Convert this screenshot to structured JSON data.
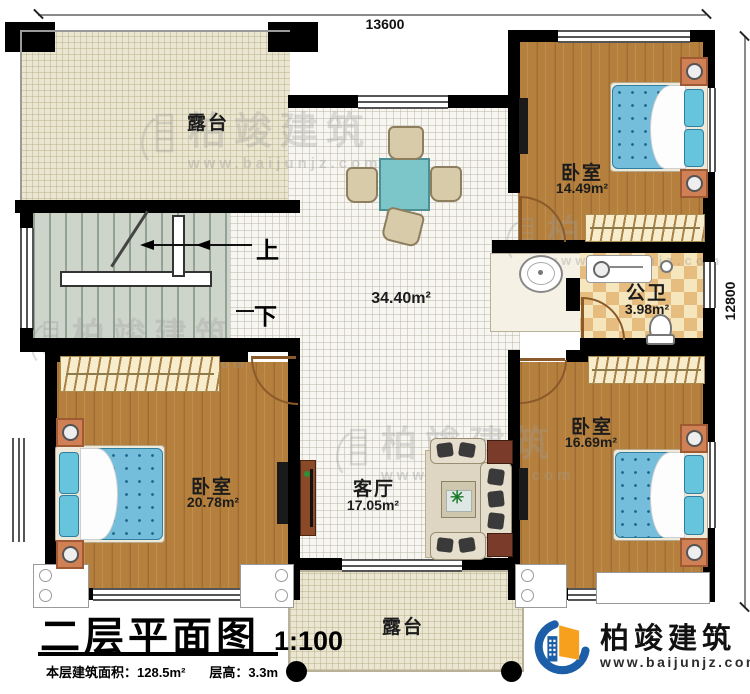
{
  "meta": {
    "title": "二层平面图",
    "scale": "1:100",
    "area_stat": "本层建筑面积：128.5m²",
    "floor_height_stat": "层高：3.3m"
  },
  "dims": {
    "top": "13600",
    "right": "12800"
  },
  "rooms": {
    "terrace_top": {
      "name": "露台"
    },
    "bedroom_top_right": {
      "name": "卧室",
      "area": "14.49m²"
    },
    "bathroom": {
      "name": "公卫",
      "area": "3.98m²"
    },
    "hall": {
      "area": "34.40m²"
    },
    "living": {
      "name": "客厅",
      "area": "17.05m²"
    },
    "bedroom_bottom_left": {
      "name": "卧室",
      "area": "20.78m²"
    },
    "bedroom_bottom_right": {
      "name": "卧室",
      "area": "16.69m²"
    },
    "terrace_bottom": {
      "name": "露台"
    }
  },
  "stairs": {
    "up": "上",
    "down": "下"
  },
  "brand": {
    "name": "柏竣建筑",
    "url": "www.baijunjz.com"
  },
  "watermark": {
    "name": "柏竣建筑",
    "url": "www.baijunjz.com"
  },
  "colors": {
    "wall": "#000000",
    "wood": "#b5803d",
    "terrace": "#ebe6d1",
    "tile": "#f7f6f1",
    "checker": "#e7bd7f",
    "stairs": "#cdd5cb",
    "bed_blue": "#74bedb",
    "brand_blue": "#1c5fa8",
    "brand_orange": "#f6a01d"
  }
}
